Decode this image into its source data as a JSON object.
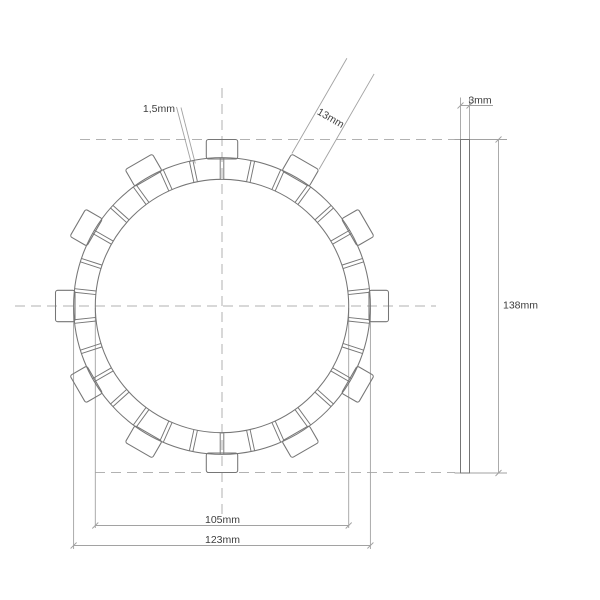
{
  "drawing": {
    "title": "clutch friction plate technical drawing",
    "views": {
      "front_view_name": "friction disc front view",
      "side_view_name": "plate thickness side view"
    },
    "colors": {
      "background": "#ffffff",
      "outline": "#767676",
      "centerline": "#b2b2b2",
      "dimension_line": "#a2a2a2",
      "text": "#3e3e3e"
    },
    "front_view": {
      "center_x": 222,
      "center_y": 306,
      "pad_outer_radius_px": 148.4,
      "pad_inner_radius_px": 126.7,
      "tab_outer_radius_px": 166.5,
      "tab_inner_radius_px": 147,
      "tab_count": 12,
      "tab_step_deg": 30,
      "tab_half_width_px": 15.7,
      "tab_corner_radius_px": 2.2,
      "groove_count": 30,
      "groove_step_deg": 12,
      "groove_half_width_px": 1.8,
      "start_angle_deg": 90
    },
    "side_view": {
      "x1": 460.5,
      "x2": 469.5,
      "y1": 139.5,
      "y2": 473
    },
    "scale_px_per_mm": 2.413,
    "dimensions": {
      "groove_width": {
        "label": "1,5mm",
        "value_mm": 1.5
      },
      "tab_width": {
        "label": "13mm",
        "value_mm": 13,
        "at_angle_deg": 60
      },
      "thickness": {
        "label": "3mm",
        "value_mm": 3
      },
      "overall_diameter": {
        "label": "138mm",
        "value_mm": 138
      },
      "inner_diameter": {
        "label": "105mm",
        "value_mm": 105
      },
      "outer_diameter": {
        "label": "123mm",
        "value_mm": 123
      }
    }
  }
}
